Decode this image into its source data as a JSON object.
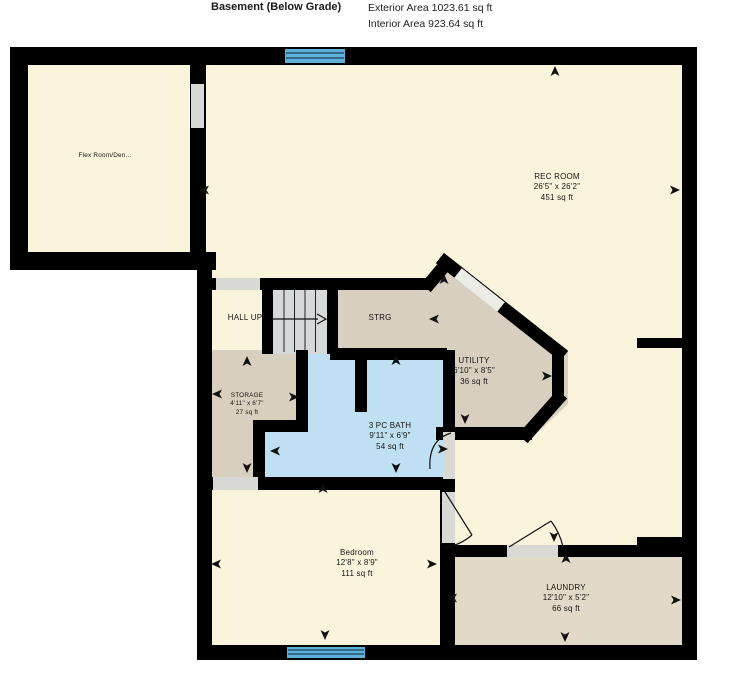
{
  "header": {
    "title": "Basement (Below Grade)",
    "exterior_area": "Exterior Area 1023.61 sq ft",
    "interior_area": "Interior Area 923.64 sq ft"
  },
  "rooms": [
    {
      "key": "flex-room",
      "name": "Flex Room/Den...",
      "dims": "",
      "area": ""
    },
    {
      "key": "rec-room",
      "name": "REC ROOM",
      "dims": "26'5\" x 26'2\"",
      "area": "451 sq ft"
    },
    {
      "key": "hall-up",
      "name": "HALL UP",
      "dims": "",
      "area": ""
    },
    {
      "key": "strg",
      "name": "STRG",
      "dims": "",
      "area": ""
    },
    {
      "key": "utility",
      "name": "UTILITY",
      "dims": "6'10\" x 8'5\"",
      "area": "36 sq ft"
    },
    {
      "key": "storage",
      "name": "STORAGE",
      "dims": "4'11\" x 6'7\"",
      "area": "27 sq ft"
    },
    {
      "key": "bath",
      "name": "3 PC BATH",
      "dims": "9'11\" x 6'9\"",
      "area": "54 sq ft"
    },
    {
      "key": "bedroom",
      "name": "Bedroom",
      "dims": "12'8\" x 8'9\"",
      "area": "111 sq ft"
    },
    {
      "key": "laundry",
      "name": "LAUNDRY",
      "dims": "12'10\" x 5'2\"",
      "area": "66 sq ft"
    }
  ],
  "colors": {
    "wall": "#000000",
    "floor_main": "#FBF4DC",
    "floor_tan": "#D9CFC0",
    "floor_laundry": "#E2D9C9",
    "floor_bath": "#BFE0F2",
    "window_glass": "#5FB0D9",
    "stairs": "#D6D8DA",
    "opening": "#D8D8D4"
  }
}
